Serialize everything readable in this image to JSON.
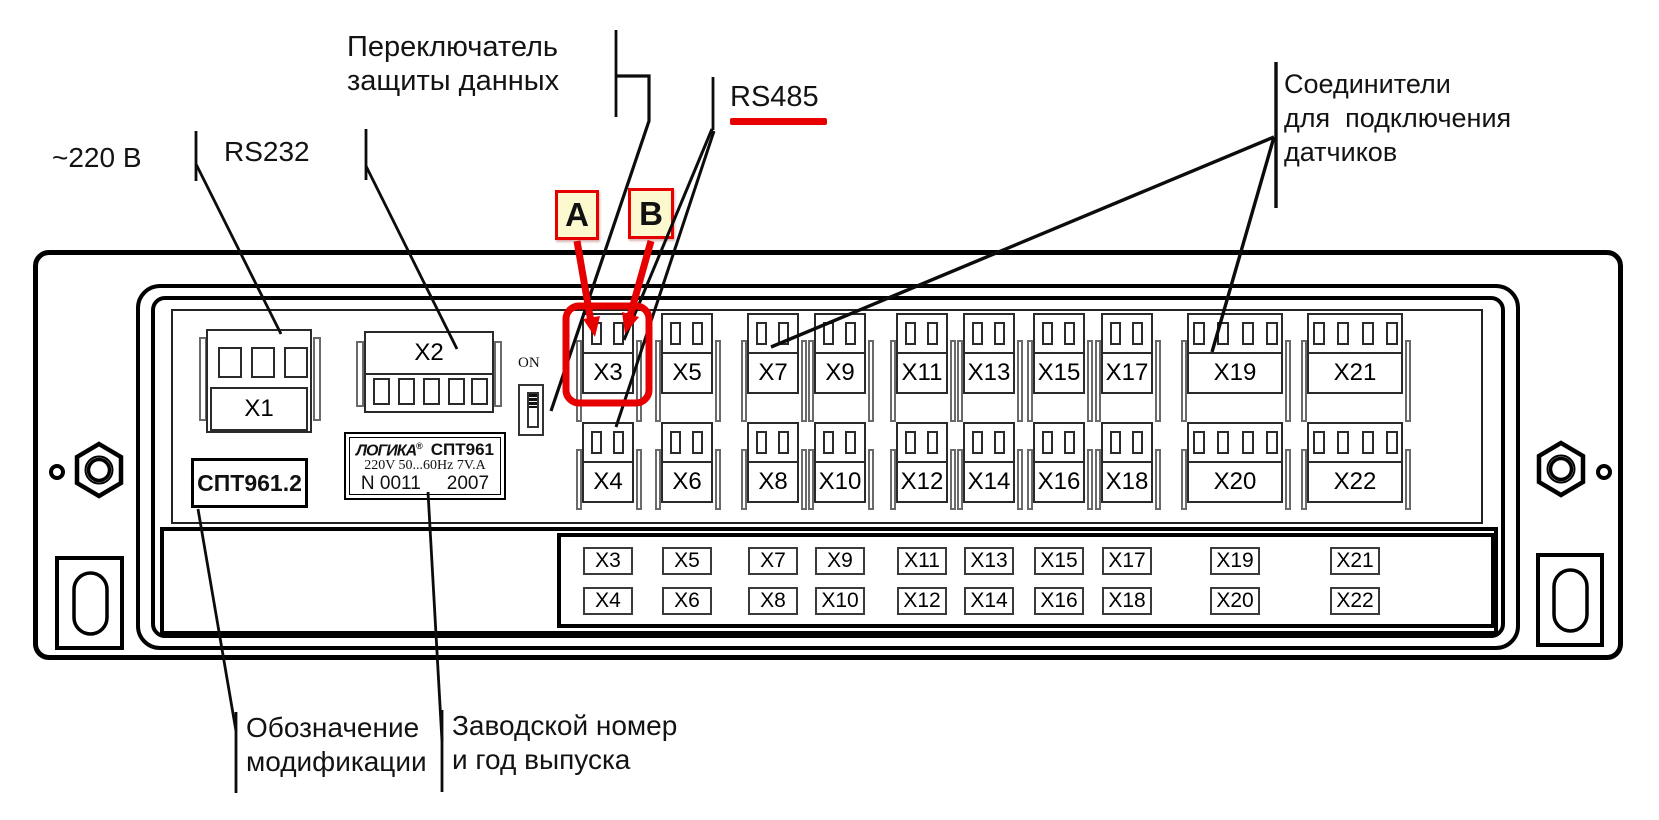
{
  "figure_title": "СПТ961 rear panel connector diagram",
  "colors": {
    "highlight_red": "#e60000",
    "ab_fill": "#fcf9ce",
    "line_black": "#0c0c0c"
  },
  "callouts": {
    "power": {
      "label": "~220 В"
    },
    "rs232": {
      "label": "RS232"
    },
    "data_protect": {
      "lines": [
        "Переключатель",
        "защиты данных"
      ]
    },
    "rs485": {
      "label": "RS485"
    },
    "rs485_wire_a": "A",
    "rs485_wire_b": "B",
    "sensors": {
      "lines": [
        "Соединители",
        "для  подключения",
        "датчиков"
      ]
    },
    "modification": {
      "lines": [
        "Обозначение",
        "модификации"
      ]
    },
    "serial": {
      "lines": [
        "Заводской номер",
        "и год выпуска"
      ]
    }
  },
  "panel": {
    "power_connector": "X1",
    "rs232_connector": "X2",
    "switch_on_label": "ON",
    "modification_label": "СПТТ961.2",
    "nameplate": {
      "brand": "ЛОГИКА",
      "reg_mark": "®",
      "model": "СПТ961",
      "rating": "220V 50...60Hz 7V.A",
      "serial_no": "N 0011",
      "year": "2007"
    },
    "sensor_connectors": {
      "top_row": [
        {
          "label": "X3",
          "pins": 2
        },
        {
          "label": "X5",
          "pins": 2
        },
        {
          "label": "X7",
          "pins": 2
        },
        {
          "label": "X9",
          "pins": 2
        },
        {
          "label": "X11",
          "pins": 2
        },
        {
          "label": "X13",
          "pins": 2
        },
        {
          "label": "X15",
          "pins": 2
        },
        {
          "label": "X17",
          "pins": 2
        },
        {
          "label": "X19",
          "pins": 4
        },
        {
          "label": "X21",
          "pins": 4
        }
      ],
      "bottom_row": [
        {
          "label": "X4",
          "pins": 2
        },
        {
          "label": "X6",
          "pins": 2
        },
        {
          "label": "X8",
          "pins": 2
        },
        {
          "label": "X10",
          "pins": 2
        },
        {
          "label": "X12",
          "pins": 2
        },
        {
          "label": "X14",
          "pins": 2
        },
        {
          "label": "X16",
          "pins": 2
        },
        {
          "label": "X18",
          "pins": 2
        },
        {
          "label": "X20",
          "pins": 4
        },
        {
          "label": "X22",
          "pins": 4
        }
      ]
    },
    "terminal_strip": {
      "top_row": [
        "X3",
        "X5",
        "X7",
        "X9",
        "X11",
        "X13",
        "X15",
        "X17",
        "X19",
        "X21"
      ],
      "bottom_row": [
        "X4",
        "X6",
        "X8",
        "X10",
        "X12",
        "X14",
        "X16",
        "X18",
        "X20",
        "X22"
      ]
    }
  }
}
